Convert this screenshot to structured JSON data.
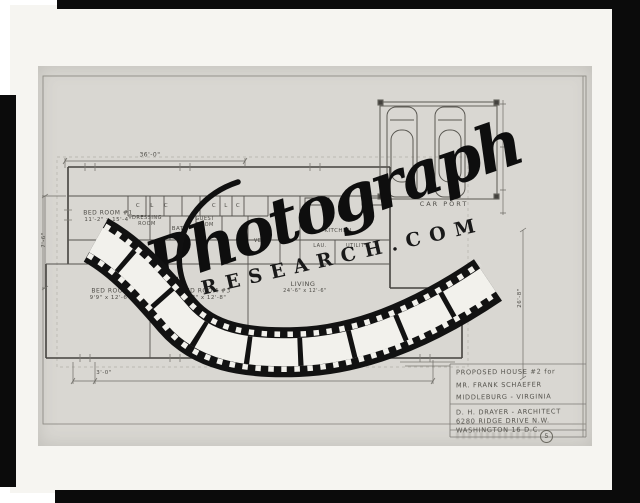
{
  "colors": {
    "frame_black": "#0b0b0b",
    "photo_paper": "#f6f5f1",
    "drawing_sheet": "#d9d7d2",
    "pencil_ink": "#4e4c47",
    "watermark_black": "#0e0e0e"
  },
  "watermark": {
    "brand_script": "Photograph",
    "brand_domain": "RESEARCH.COM",
    "film_strip_icon": "film-strip"
  },
  "title_block": {
    "line1": "PROPOSED HOUSE #2 for",
    "line2": "MR. FRANK SCHAEFER",
    "line3": "MIDDLEBURG - VIRGINIA",
    "line4": "D. H. DRAYER - ARCHITECT",
    "line5": "6280 RIDGE DRIVE N.W.",
    "line6": "WASHINGTON 16 D.C.",
    "sheet_number": "5"
  },
  "plan_labels": [
    {
      "t": "C",
      "x": 138,
      "y": 206,
      "s": 5.5
    },
    {
      "t": "L",
      "x": 152,
      "y": 206,
      "s": 5.5
    },
    {
      "t": "C",
      "x": 166,
      "y": 206,
      "s": 5.5
    },
    {
      "t": "C",
      "x": 214,
      "y": 206,
      "s": 5.5
    },
    {
      "t": "L",
      "x": 226,
      "y": 206,
      "s": 5.5
    },
    {
      "t": "C",
      "x": 238,
      "y": 206,
      "s": 5.5
    },
    {
      "t": "BED ROOM #1",
      "x": 108,
      "y": 213,
      "s": 6
    },
    {
      "t": "11'-2\" x 15'-4\"",
      "x": 108,
      "y": 220,
      "s": 5.5
    },
    {
      "t": "DRESSING",
      "x": 147,
      "y": 218,
      "s": 5
    },
    {
      "t": "ROOM",
      "x": 147,
      "y": 224,
      "s": 5
    },
    {
      "t": "BATH",
      "x": 180,
      "y": 229,
      "s": 5.5
    },
    {
      "t": "GUEST",
      "x": 205,
      "y": 219,
      "s": 5
    },
    {
      "t": "ROOM",
      "x": 205,
      "y": 225,
      "s": 5
    },
    {
      "t": "VEST.",
      "x": 262,
      "y": 241,
      "s": 5
    },
    {
      "t": "KITCHEN",
      "x": 338,
      "y": 231,
      "s": 5.5
    },
    {
      "t": "LAU.",
      "x": 320,
      "y": 246,
      "s": 5
    },
    {
      "t": "UTILITY",
      "x": 357,
      "y": 246,
      "s": 5
    },
    {
      "t": "BATH",
      "x": 163,
      "y": 285,
      "s": 5.5
    },
    {
      "t": "BED ROOM",
      "x": 110,
      "y": 291,
      "s": 6
    },
    {
      "t": "9'9\" x 12'-6\"",
      "x": 110,
      "y": 298,
      "s": 5.5
    },
    {
      "t": "BED ROOM #3",
      "x": 206,
      "y": 291,
      "s": 6
    },
    {
      "t": "9'3\" x 12'-8\"",
      "x": 206,
      "y": 298,
      "s": 5.5
    },
    {
      "t": "LIVING",
      "x": 303,
      "y": 284,
      "s": 6.5
    },
    {
      "t": "24'-6\" x 12'-6\"",
      "x": 305,
      "y": 291,
      "s": 5
    },
    {
      "t": "DINING SPACE",
      "x": 421,
      "y": 310,
      "s": 6
    },
    {
      "t": "CAR PORT",
      "x": 444,
      "y": 204,
      "s": 6.5,
      "ls": 2
    },
    {
      "t": "36'-0\"",
      "x": 150,
      "y": 155,
      "s": 6
    },
    {
      "t": "68'-8\"",
      "x": 266,
      "y": 374,
      "s": 6
    },
    {
      "t": "3'-0\"",
      "x": 104,
      "y": 373,
      "s": 5.5
    },
    {
      "t": "7'-6\"",
      "x": 44,
      "y": 240,
      "s": 5.5,
      "r": -90
    },
    {
      "t": "26'-8\"",
      "x": 520,
      "y": 298,
      "s": 5.5,
      "r": -90
    }
  ]
}
